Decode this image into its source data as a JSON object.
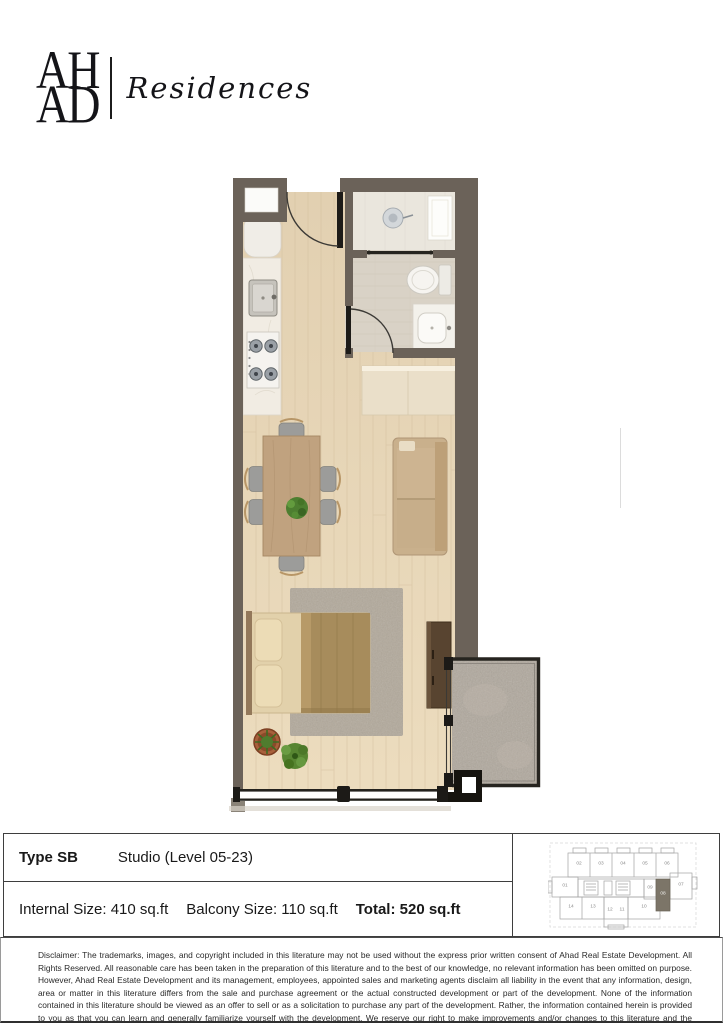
{
  "brand": {
    "monogram_line1": "AH",
    "monogram_line2": "AD",
    "wordmark": "Residences"
  },
  "unit_info": {
    "type_label": "Type SB",
    "description": "Studio (Level 05-23)",
    "internal_size": "Internal Size: 410 sq.ft",
    "balcony_size": "Balcony Size: 110 sq.ft",
    "total_size": "Total: 520 sq.ft"
  },
  "keyplan": {
    "highlighted_unit": "08",
    "units": [
      {
        "label": "01",
        "x": 17,
        "y": 48
      },
      {
        "label": "02",
        "x": 31,
        "y": 26
      },
      {
        "label": "03",
        "x": 53,
        "y": 26
      },
      {
        "label": "04",
        "x": 75,
        "y": 26
      },
      {
        "label": "05",
        "x": 97,
        "y": 26
      },
      {
        "label": "06",
        "x": 119,
        "y": 26
      },
      {
        "label": "07",
        "x": 133,
        "y": 47
      },
      {
        "label": "08",
        "x": 115,
        "y": 56,
        "highlighted": true
      },
      {
        "label": "09",
        "x": 102,
        "y": 50
      },
      {
        "label": "10",
        "x": 96,
        "y": 69
      },
      {
        "label": "11",
        "x": 74,
        "y": 72
      },
      {
        "label": "12",
        "x": 62,
        "y": 72
      },
      {
        "label": "13",
        "x": 45,
        "y": 69
      },
      {
        "label": "14",
        "x": 23,
        "y": 69
      }
    ]
  },
  "floorplan": {
    "features": [
      "kitchen",
      "entry-door",
      "shower-room",
      "bathroom",
      "wardrobe",
      "dining-table",
      "sofa",
      "bed",
      "rug",
      "floor-plants",
      "tv-console",
      "balcony",
      "window-wall"
    ],
    "colors": {
      "wall": "#6b6259",
      "wood_floor": "#e6d5b8",
      "bathroom_floor": "#d9d2c6",
      "shower_floor": "#eae6dd",
      "counter_marble": "#f1ece3",
      "furniture_tan": "#c9b08c",
      "duvet_khaki": "#a78c5c",
      "rug_gray": "#b2a99b",
      "balcony_stone": "#b0a89d",
      "plant_green": "#4d7e30",
      "console_brown": "#584430",
      "keyplan_highlight": "#7c7568"
    }
  },
  "disclaimer": "Disclaimer: The trademarks, images, and copyright included in this literature may not be used without the express prior written consent of Ahad Real Estate Development. All Rights Reserved. All reasonable care has been taken in the preparation of this literature and to the best of our knowledge, no relevant information has been omitted on purpose. However, Ahad Real Estate Development and its management, employees, appointed sales and marketing agents disclaim all liability in the event that any information, design, area or matter in this literature differs from the sale and purchase agreement or the actual constructed development or part of the development. None of the information contained in this literature should be viewed as an offer to sell or as a solicitation to purchase any part of the development. Rather, the information contained herein is provided to you as that you can learn and generally familiarize yourself with the development. We reserve our right to make improvements and/or changes to this literature and the information, designs or areas contained in at any time without notice or obligation."
}
